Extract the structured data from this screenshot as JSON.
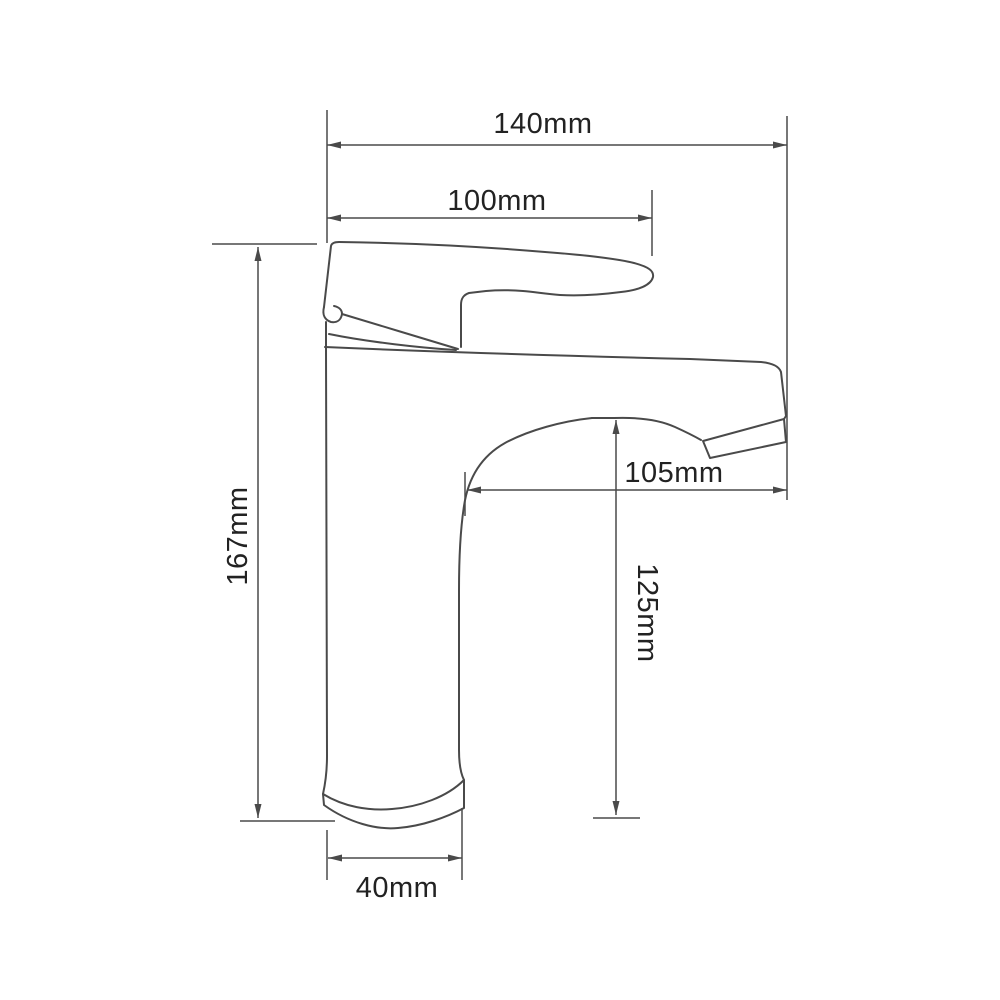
{
  "drawing": {
    "title": "faucet-dimension-diagram",
    "background_color": "#ffffff",
    "line_color": "#4a4a4a",
    "text_color": "#222222",
    "dims": {
      "overall_width": {
        "label": "140mm",
        "value": 140,
        "unit": "mm"
      },
      "handle_reach": {
        "label": "100mm",
        "value": 100,
        "unit": "mm"
      },
      "spout_reach": {
        "label": "105mm",
        "value": 105,
        "unit": "mm"
      },
      "spout_height": {
        "label": "125mm",
        "value": 125,
        "unit": "mm"
      },
      "overall_height": {
        "label": "167mm",
        "value": 167,
        "unit": "mm"
      },
      "base_width": {
        "label": "40mm",
        "value": 40,
        "unit": "mm"
      }
    }
  }
}
